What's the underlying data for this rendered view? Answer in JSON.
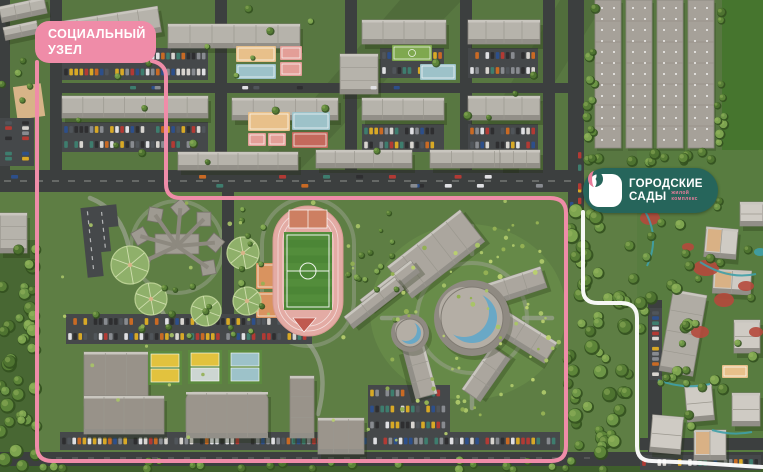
{
  "annotations": {
    "social_node": {
      "line1": "СОЦИАЛЬНЫЙ",
      "line2": "УЗЕЛ"
    },
    "logo": {
      "name_line1": "ГОРОДСКИЕ",
      "name_line2": "САДЫ",
      "type_line1": "жилой",
      "type_line2": "комплекс"
    }
  },
  "colors": {
    "accent_pink": "#EF8CA8",
    "outline_white": "#FFFFFF",
    "badge_teal": "#26655B",
    "badge_pink": "#E87E9C",
    "grass": "#5E7E44",
    "grass_top": "#587741",
    "grass_field": "#46752E",
    "park_light": "#6E934C",
    "forest_dark": "#3F5E2C",
    "road": "#3C3F3F",
    "asphalt": "#45484A",
    "roof_gray": "#B6B3AB",
    "roof_dark": "#928F88",
    "warehouse_roof": "#A6A199",
    "track_pink": "#E3ABA4",
    "field_green": "#4C8636",
    "court_tan": "#E8C08A",
    "court_blue": "#9DC2C9",
    "court_salmon": "#E39E97",
    "court_red": "#C4695C",
    "court_yellow": "#E2C23E",
    "court_clay": "#CD7F62",
    "sand": "#D7B488",
    "dome_glass": "#69A8C6",
    "landscape_red": "#B5493C",
    "landscape_teal": "#3FA0A8",
    "tree_greens": [
      "#4E7330",
      "#5D8539",
      "#6C9546",
      "#7DA44F",
      "#577D36"
    ],
    "bush_greens": [
      "#A9C468",
      "#93B053",
      "#B9CF6F"
    ],
    "car_colors": [
      "#D8D5D0",
      "#2E2E30",
      "#B23A34",
      "#2D4F8A",
      "#D8A926",
      "#3E7D6E",
      "#C96A24",
      "#888B90",
      "#E0E0E3",
      "#50555A"
    ]
  }
}
